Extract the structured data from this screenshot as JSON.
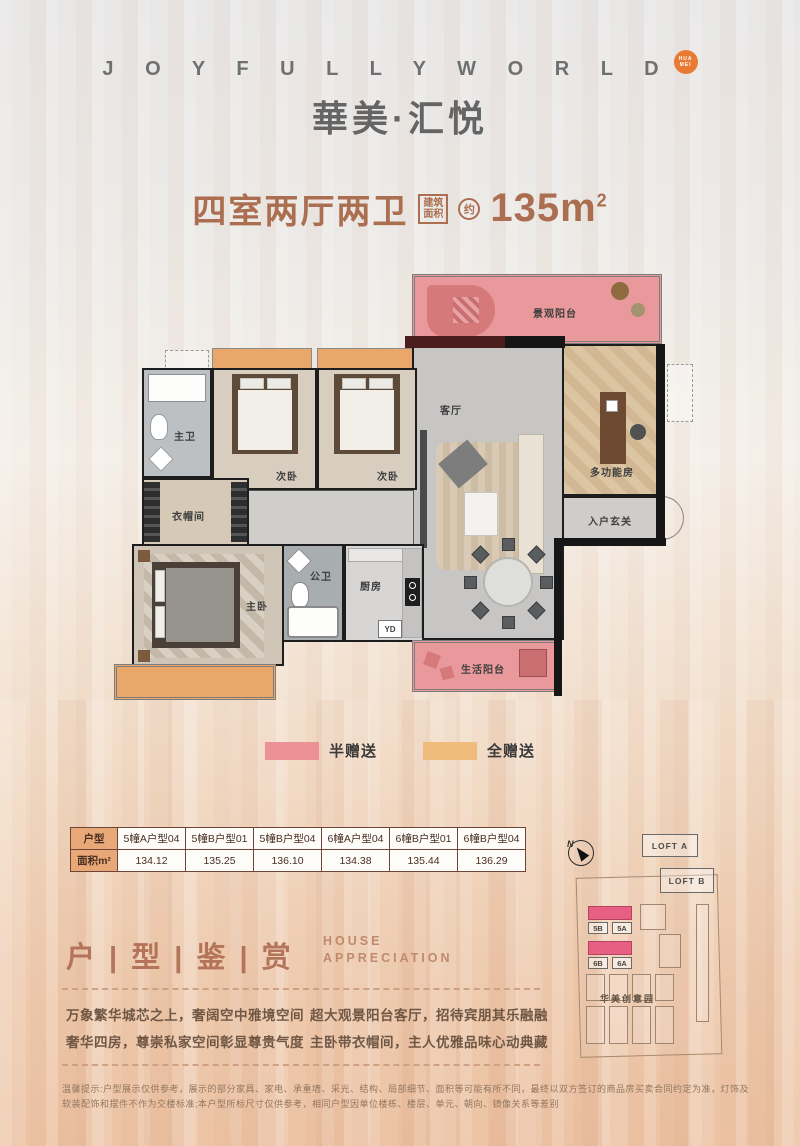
{
  "palette": {
    "accent": "#ab6e50",
    "half_gift": "#ec9195",
    "full_gift": "#f0bc7e",
    "table_header": "#e9a877",
    "logo_badge": "#e87a33"
  },
  "header": {
    "logo_en": "J O Y F U L L Y  W O R L D",
    "badge_line1": "HUA",
    "badge_line2": "MEI",
    "logo_cn": "華美·汇悦"
  },
  "title": {
    "name": "四室两厅两卫",
    "area_box_line1": "建筑",
    "area_box_line2": "面积",
    "approx": "约",
    "area_value": "135m",
    "area_sup": "2"
  },
  "floorplan": {
    "rooms": {
      "view_balcony": "景观阳台",
      "living": "客厅",
      "multi_room": "多功能房",
      "foyer": "入户玄关",
      "bedroom_a": "次卧",
      "bedroom_b": "次卧",
      "master_bath": "主卫",
      "cloakroom": "衣帽间",
      "master": "主卧",
      "public_bath": "公卫",
      "kitchen": "厨房",
      "yd": "YD",
      "life_balcony": "生活阳台"
    }
  },
  "legend": {
    "half_label": "半赠送",
    "full_label": "全赠送"
  },
  "table": {
    "row_type_label": "户型",
    "row_area_label": "面积m²",
    "columns": [
      {
        "type": "5幢A户型04",
        "area": "134.12"
      },
      {
        "type": "5幢B户型01",
        "area": "135.25"
      },
      {
        "type": "5幢B户型04",
        "area": "136.10"
      },
      {
        "type": "6幢A户型04",
        "area": "134.38"
      },
      {
        "type": "6幢B户型01",
        "area": "135.44"
      },
      {
        "type": "6幢B户型04",
        "area": "136.29"
      }
    ]
  },
  "appreciation": {
    "cn": "户 | 型 | 鉴 | 赏",
    "en_line1": "HOUSE",
    "en_line2": "APPRECIATION",
    "col1_line1": "万象繁华城芯之上，奢阔空中雅境空间",
    "col1_line2": "奢华四房，尊崇私家空间彰显尊贵气度",
    "col2_line1": "超大观景阳台客厅，招待宾朋其乐融融",
    "col2_line2": "主卧带衣帽间，主人优雅品味心动典藏"
  },
  "sitemap": {
    "north": "N",
    "loft_a": "LOFT A",
    "loft_b": "LOFT B",
    "b5b": "5B",
    "b5a": "5A",
    "b6b": "6B",
    "b6a": "6A",
    "park": "华美创意园"
  },
  "disclaimer": "温馨提示:户型展示仅供参考，展示的部分家具、家电、承重墙、采光、结构、局部细节、面积等可能有所不同，最终以双方签订的商品房买卖合同约定为准，灯饰及软装配饰和摆件不作为交楼标准;本户型所标尺寸仅供参考，相同户型因单位楼栋、楼层、单元、朝向、镜像关系等差别"
}
